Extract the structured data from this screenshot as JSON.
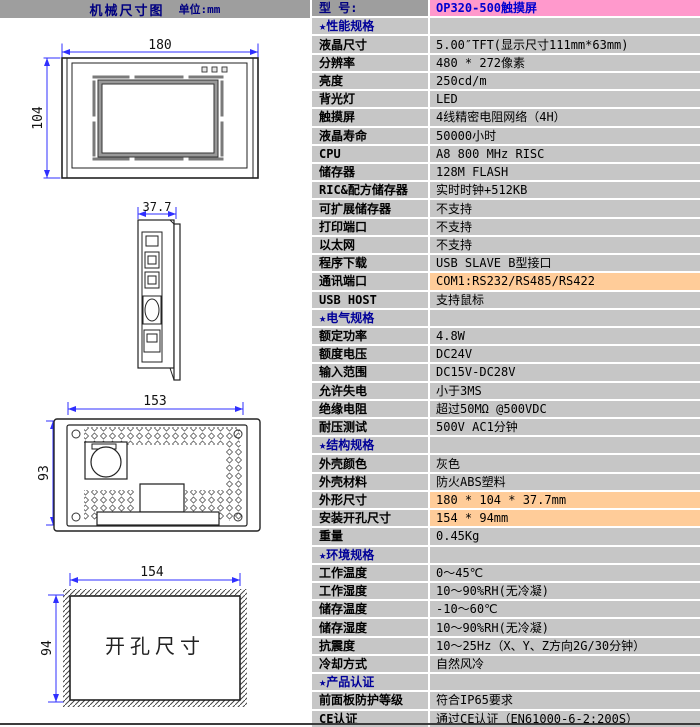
{
  "left_header": {
    "title": "机械尺寸图",
    "unit": "单位:mm"
  },
  "diagrams": {
    "front": {
      "width_dim": "180",
      "height_dim": "104"
    },
    "side": {
      "depth_dim": "37.7"
    },
    "rear": {
      "width_dim": "153",
      "height_dim": "93"
    },
    "cutout": {
      "width_dim": "154",
      "height_dim": "94",
      "label": "开孔尺寸"
    }
  },
  "table": {
    "rows": [
      {
        "type": "model",
        "label": "型  号:",
        "value": "OP320-500触摸屏"
      },
      {
        "type": "section",
        "label": "★性能规格",
        "value": ""
      },
      {
        "label": "液晶尺寸",
        "value": "5.00″TFT(显示尺寸111mm*63mm)"
      },
      {
        "label": "分辨率",
        "value": "480 * 272像素"
      },
      {
        "label": "亮度",
        "value": "250cd/m"
      },
      {
        "label": "背光灯",
        "value": "LED"
      },
      {
        "label": "触摸屏",
        "value": "4线精密电阻网络（4H）"
      },
      {
        "label": "液晶寿命",
        "value": "50000小时"
      },
      {
        "label": "CPU",
        "value": "A8 800 MHz RISC"
      },
      {
        "label": "储存器",
        "value": "128M FLASH"
      },
      {
        "label": "RIC&配方储存器",
        "value": "实时时钟+512KB"
      },
      {
        "label": "可扩展储存器",
        "value": "不支持"
      },
      {
        "label": "打印端口",
        "value": "不支持"
      },
      {
        "label": "以太网",
        "value": "不支持"
      },
      {
        "label": "程序下载",
        "value": "USB SLAVE B型接口"
      },
      {
        "label": "通讯端口",
        "value": "COM1:RS232/RS485/RS422",
        "highlight": true
      },
      {
        "label": "USB HOST",
        "value": "支持鼠标"
      },
      {
        "type": "section",
        "label": "★电气规格",
        "value": ""
      },
      {
        "label": "额定功率",
        "value": "4.8W"
      },
      {
        "label": "额度电压",
        "value": "DC24V"
      },
      {
        "label": "输入范围",
        "value": "DC15V-DC28V"
      },
      {
        "label": "允许失电",
        "value": "小于3MS"
      },
      {
        "label": "绝缘电阻",
        "value": "超过50MΩ @500VDC"
      },
      {
        "label": "耐压测试",
        "value": "500V AC1分钟"
      },
      {
        "type": "section",
        "label": "★结构规格",
        "value": ""
      },
      {
        "label": "外壳颜色",
        "value": "灰色"
      },
      {
        "label": "外壳材料",
        "value": "防火ABS塑料"
      },
      {
        "label": "外形尺寸",
        "value": "180 * 104 * 37.7mm",
        "highlight": true
      },
      {
        "label": "安装开孔尺寸",
        "value": "154 * 94mm",
        "highlight": true
      },
      {
        "label": "重量",
        "value": "0.45Kg"
      },
      {
        "type": "section",
        "label": "★环境规格",
        "value": ""
      },
      {
        "label": "工作温度",
        "value": "0～45℃"
      },
      {
        "label": "工作湿度",
        "value": "10～90%RH(无冷凝)"
      },
      {
        "label": "储存温度",
        "value": "-10～60℃"
      },
      {
        "label": "储存湿度",
        "value": "10～90%RH(无冷凝)"
      },
      {
        "label": "抗震度",
        "value": "10～25Hz（X、Y、Z方向2G/30分钟）"
      },
      {
        "label": "冷却方式",
        "value": "自然风冷"
      },
      {
        "type": "section",
        "label": "★产品认证",
        "value": ""
      },
      {
        "label": "前面板防护等级",
        "value": "符合IP65要求"
      },
      {
        "label": "CE认证",
        "value": "通过CE认证（EN61000-6-2:200S）"
      }
    ]
  },
  "colors": {
    "table_bg": "#c6c6c6",
    "header_bg": "#9e9e9e",
    "model_value_bg": "#ff99cc",
    "highlight_bg": "#ffcc99",
    "section_text": "#000099",
    "model_text": "#0000d0",
    "dimension_line": "#2f2fff",
    "gridline": "#ffffff"
  }
}
